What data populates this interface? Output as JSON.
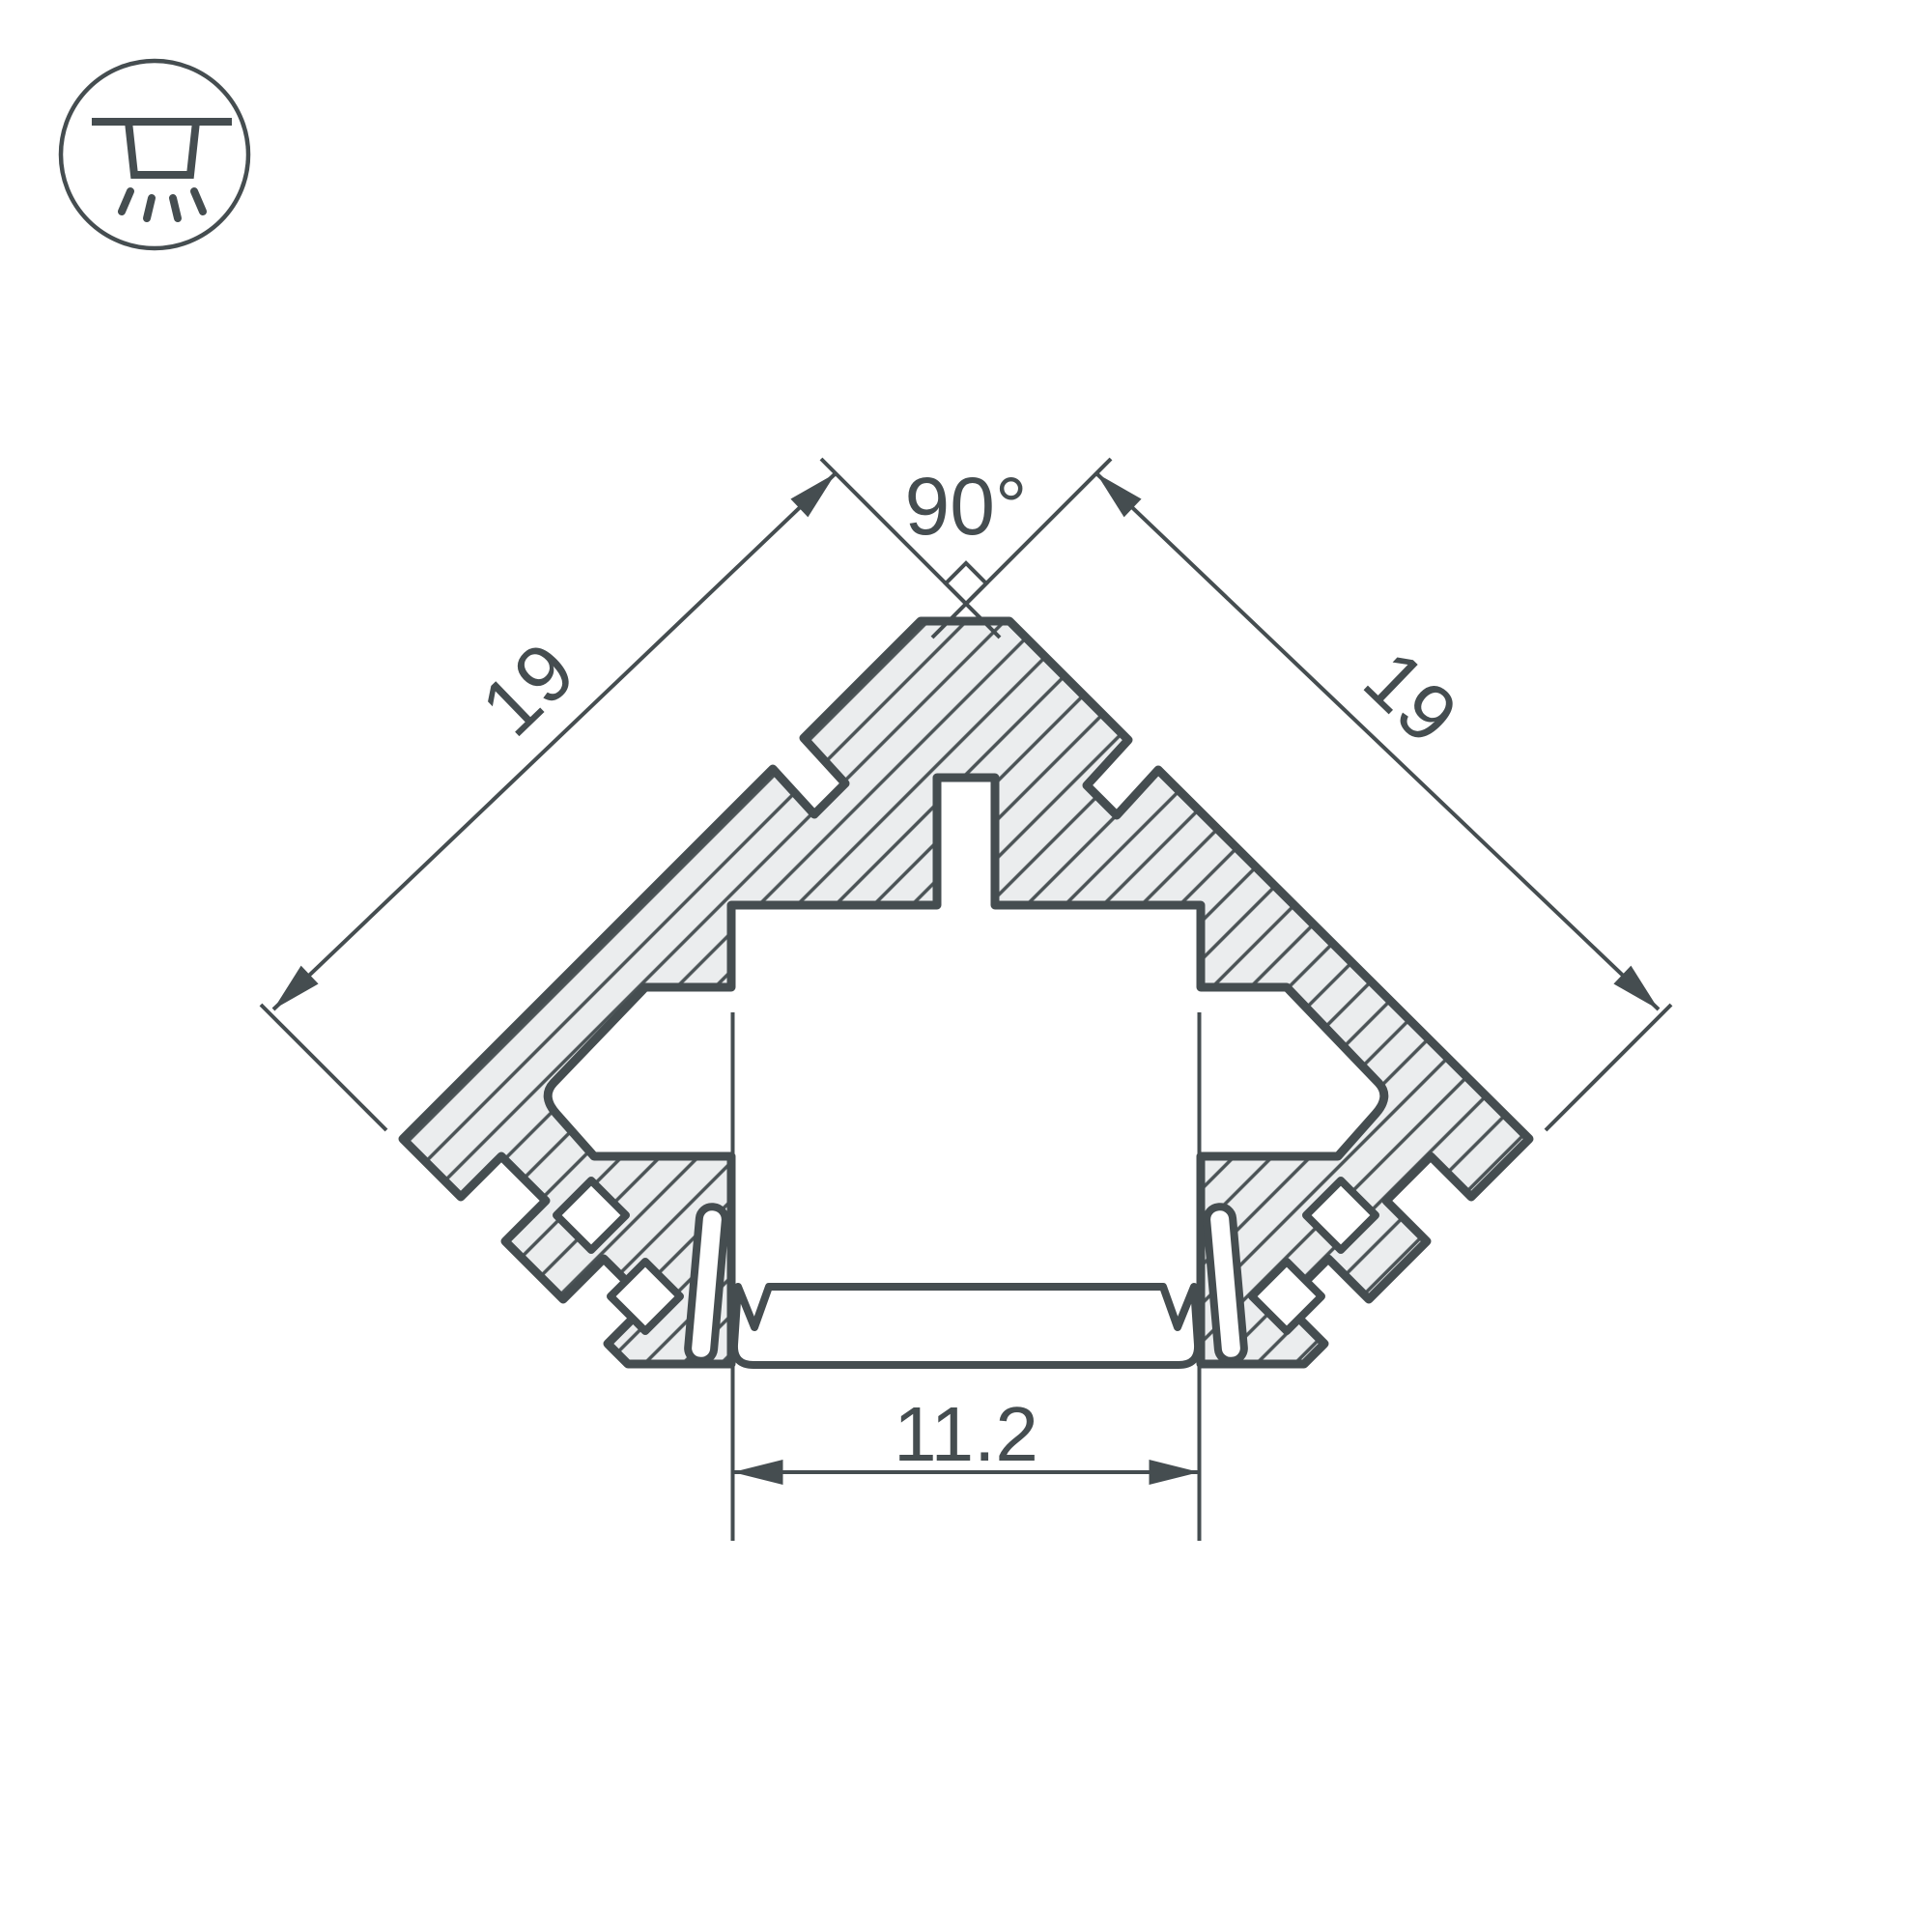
{
  "drawing": {
    "type": "led-corner-profile-cross-section",
    "dimensions": {
      "left_edge": "19",
      "right_edge": "19",
      "apex_angle": "90°",
      "opening_width": "11.2"
    },
    "icon": {
      "name": "recessed-ceiling-light"
    },
    "colors": {
      "line": "#454d50",
      "material_fill": "#ebedee",
      "hatch_line": "#4b5356",
      "background": "#ffffff"
    }
  }
}
